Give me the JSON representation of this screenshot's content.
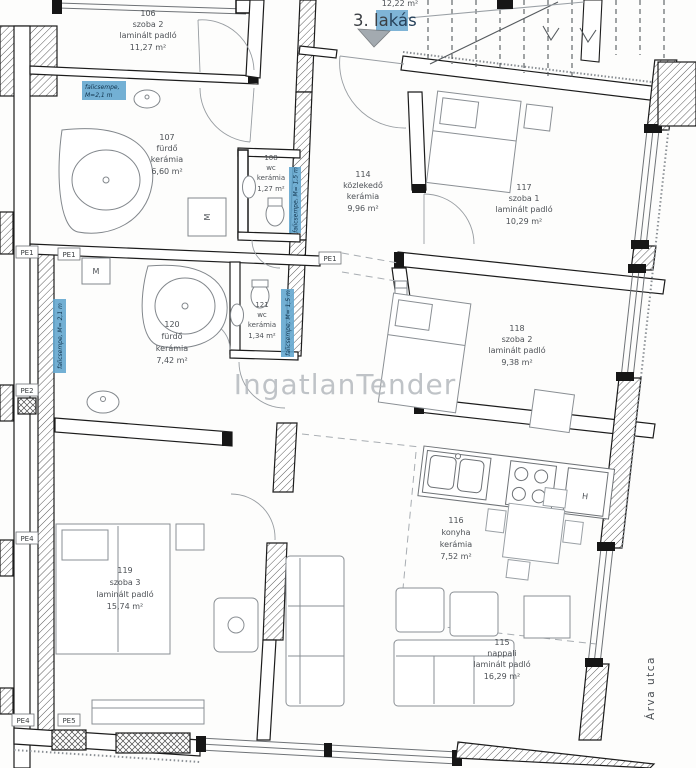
{
  "plan": {
    "title": {
      "prefix": "3. la",
      "highlight": "kás"
    },
    "watermark": "IngatlanTender",
    "street_name": "Árva utca",
    "partial_area_top": "12,22 m²",
    "rooms": {
      "r106": {
        "number": "106",
        "name": "szoba 2",
        "floor": "laminált padló",
        "area": "11,27 m²"
      },
      "r107": {
        "number": "107",
        "name": "fürdő",
        "floor": "kerámia",
        "area": "6,60 m²"
      },
      "r108": {
        "number": "108",
        "name": "wc",
        "floor": "kerámia",
        "area": "1,27 m²"
      },
      "r114": {
        "number": "114",
        "name": "közlekedő",
        "floor": "kerámia",
        "area": "9,96 m²"
      },
      "r115": {
        "number": "115",
        "name": "nappali",
        "floor": "laminált padló",
        "area": "16,29 m²"
      },
      "r116": {
        "number": "116",
        "name": "konyha",
        "floor": "kerámia",
        "area": "7,52 m²"
      },
      "r117": {
        "number": "117",
        "name": "szoba 1",
        "floor": "laminált padló",
        "area": "10,29 m²"
      },
      "r118": {
        "number": "118",
        "name": "szoba 2",
        "floor": "laminált padló",
        "area": "9,38 m²"
      },
      "r119": {
        "number": "119",
        "name": "szoba 3",
        "floor": "laminált padló",
        "area": "15,74 m²"
      },
      "r120": {
        "number": "120",
        "name": "fürdő",
        "floor": "kerámia",
        "area": "7,42 m²"
      },
      "r121": {
        "number": "121",
        "name": "wc",
        "floor": "kerámia",
        "area": "1,34 m²"
      }
    },
    "tile_labels": {
      "top_line1": "falicsempe,",
      "top_line2": "M=2,1 m",
      "left_vertical": "falicsempe, M= 2,1 m",
      "wc108_vertical": "falicsempe, M= 1,5 m",
      "wc121_vertical": "falicsempe, M= 1,5 m"
    },
    "pe_labels": {
      "left_top_a": "PE1",
      "left_top_b": "PE1",
      "center": "PE1",
      "left_mid": "PE2",
      "left_lower": "PE4",
      "bottom_a": "PE4",
      "bottom_b": "PE5"
    },
    "appliances": {
      "washer_107": "M",
      "washer_120": "M",
      "fridge_116": "H"
    },
    "colors": {
      "tile_label_blue": "#5b9fc6",
      "title_highlight_blue": "#68a7cf",
      "watermark_gray": "#b5b9be"
    }
  }
}
